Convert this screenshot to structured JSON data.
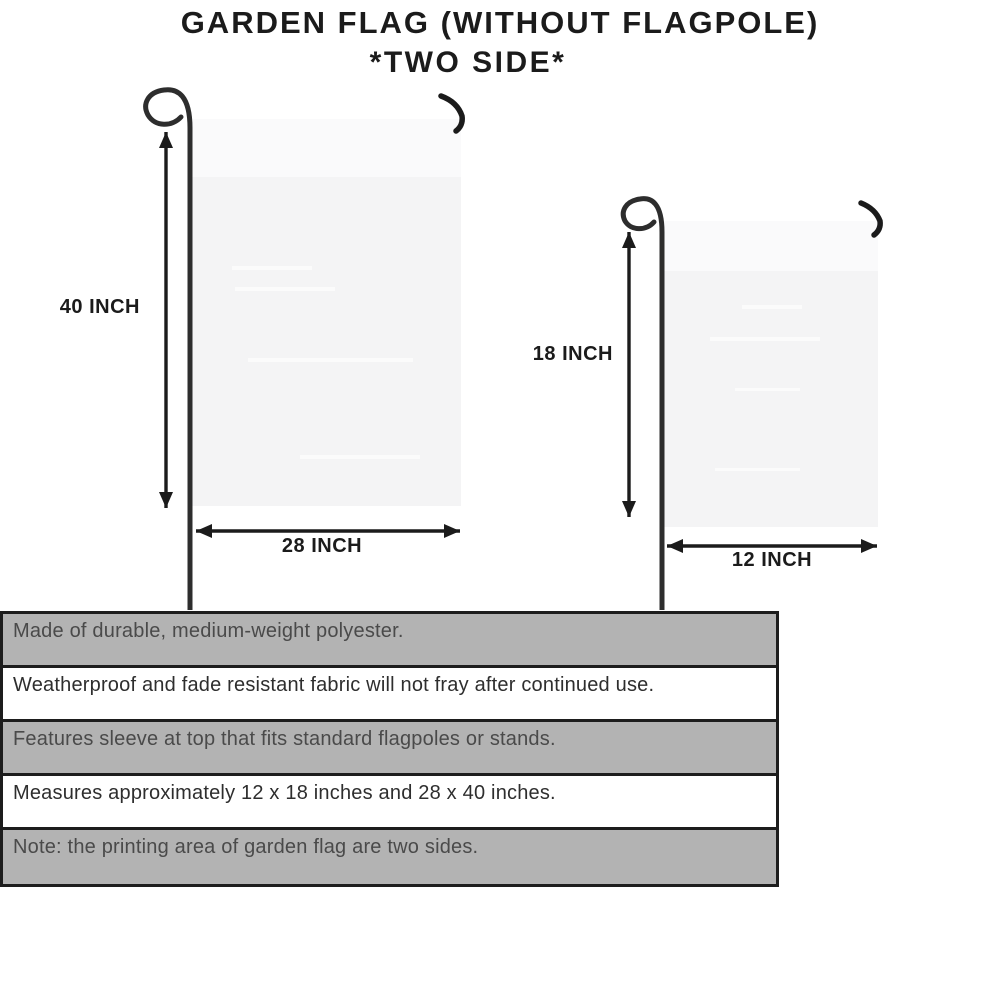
{
  "title": {
    "line1": "GARDEN FLAG (WITHOUT FLAGPOLE)",
    "line2": "*TWO SIDE*"
  },
  "diagram": {
    "large_flag": {
      "height_label": "40 INCH",
      "width_label": "28 INCH"
    },
    "small_flag": {
      "height_label": "18 INCH",
      "width_label": "12 INCH"
    }
  },
  "features": {
    "rows": [
      {
        "text": "Made of durable, medium-weight polyester.",
        "shaded": true
      },
      {
        "text": "Weatherproof and fade resistant fabric will not fray after continued use.",
        "shaded": false
      },
      {
        "text": "Features sleeve at top that fits standard flagpoles or stands.",
        "shaded": true
      },
      {
        "text": "Measures approximately 12 x 18 inches and 28 x 40 inches.",
        "shaded": false
      },
      {
        "text": "Note: the printing area of garden flag are two sides.",
        "shaded": true
      }
    ]
  },
  "colors": {
    "row_shaded": "#b3b3b3",
    "row_plain": "#ffffff",
    "table_border": "#1d1d1d",
    "flag_fill": "#f4f4f5",
    "flag_sleeve": "#fafafb",
    "pole": "#2d2d2d",
    "ink": "#1b1b1b",
    "row_text_shaded": "#4a4a4a",
    "row_text_plain": "#2e2e2e",
    "background": "#ffffff"
  }
}
